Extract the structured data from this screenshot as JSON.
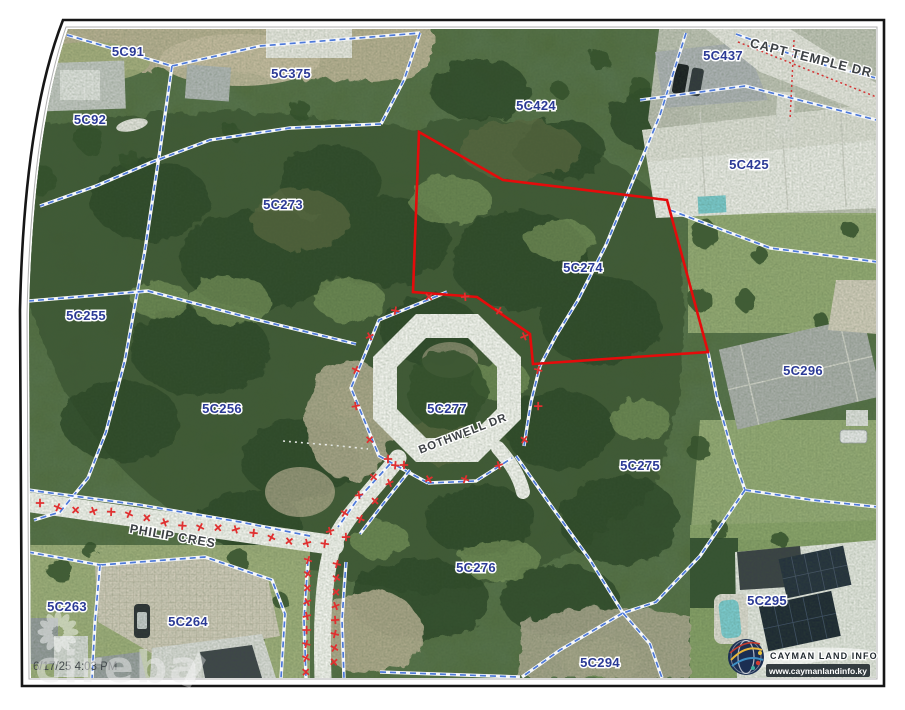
{
  "map": {
    "timestamp": "6/17/25 4:03 PM",
    "watermark_text": "cireba",
    "highlighted_parcel": "5C274",
    "logo": {
      "title": "CAYMAN LAND INFO",
      "website": "www.caymanlandinfo.ky"
    },
    "parcel_labels": [
      {
        "label": "5C91"
      },
      {
        "label": "5C92"
      },
      {
        "label": "5C375"
      },
      {
        "label": "5C424"
      },
      {
        "label": "5C437"
      },
      {
        "label": "5C425"
      },
      {
        "label": "5C273"
      },
      {
        "label": "5C274"
      },
      {
        "label": "5C255"
      },
      {
        "label": "5C256"
      },
      {
        "label": "5C277"
      },
      {
        "label": "5C296"
      },
      {
        "label": "5C275"
      },
      {
        "label": "5C276"
      },
      {
        "label": "5C294"
      },
      {
        "label": "5C295"
      },
      {
        "label": "5C263"
      },
      {
        "label": "5C264"
      }
    ],
    "road_labels": [
      {
        "label": "CAPT TEMPLE DR"
      },
      {
        "label": "BOTHWELL DR"
      },
      {
        "label": "PHILIP CRES"
      }
    ],
    "colors": {
      "parcel_label": "#2b3a96",
      "boundary_blue": "#4d79d9",
      "highlight_red": "#e50b0b",
      "marker_red": "#e03030",
      "road_label_text": "#3d4145"
    }
  }
}
